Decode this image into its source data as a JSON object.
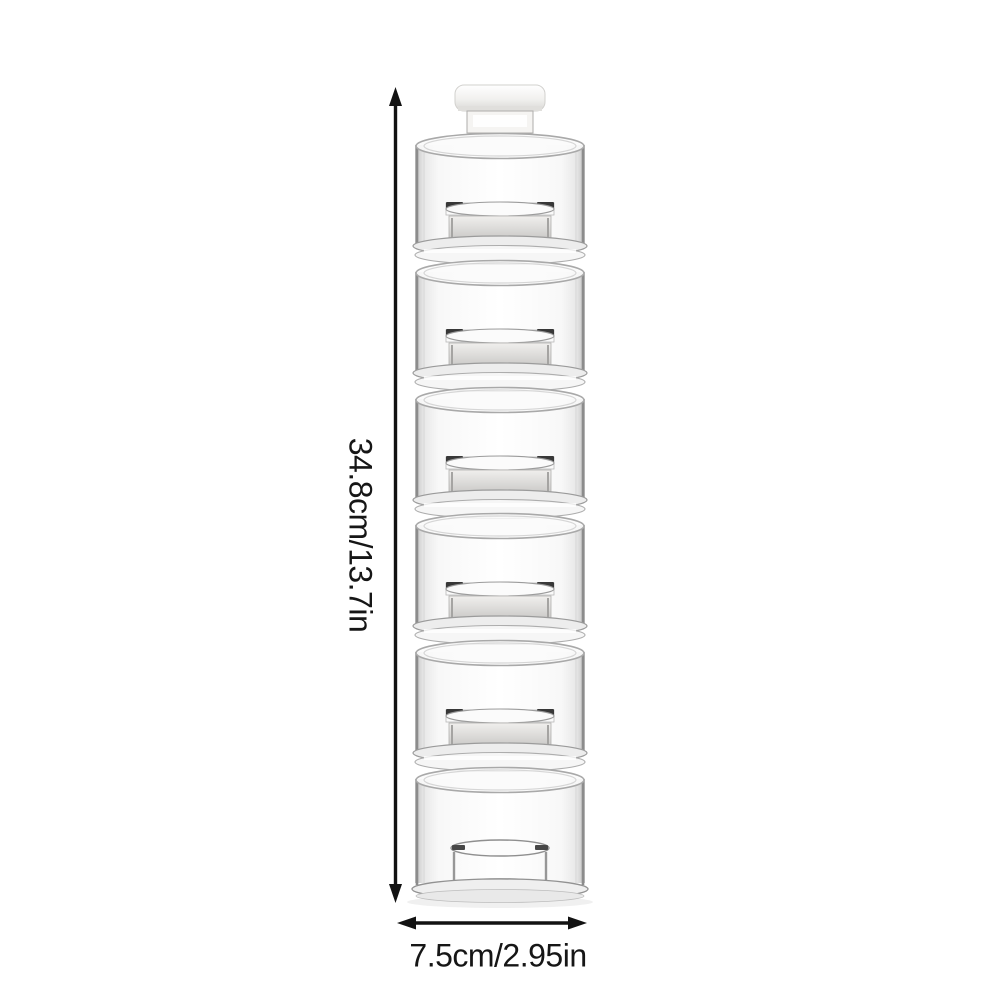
{
  "page": {
    "background_color": "#ffffff"
  },
  "dimensions": {
    "height_label": "34.8cm/13.7in",
    "width_label": "7.5cm/2.95in"
  },
  "product": {
    "description": "Clear six-tier stackable spice jar tower with white inner lids, white top cap and clear base ring",
    "tier_count": 6
  },
  "colors": {
    "annotation_text": "#161616",
    "arrow": "#121212",
    "glass_edge": "#8c8c8c",
    "glass_highlight": "#ffffff",
    "lid_gray": "#d0cfcd",
    "lid_accent_dark": "#383838",
    "cap_white": "#f4f3f1"
  }
}
